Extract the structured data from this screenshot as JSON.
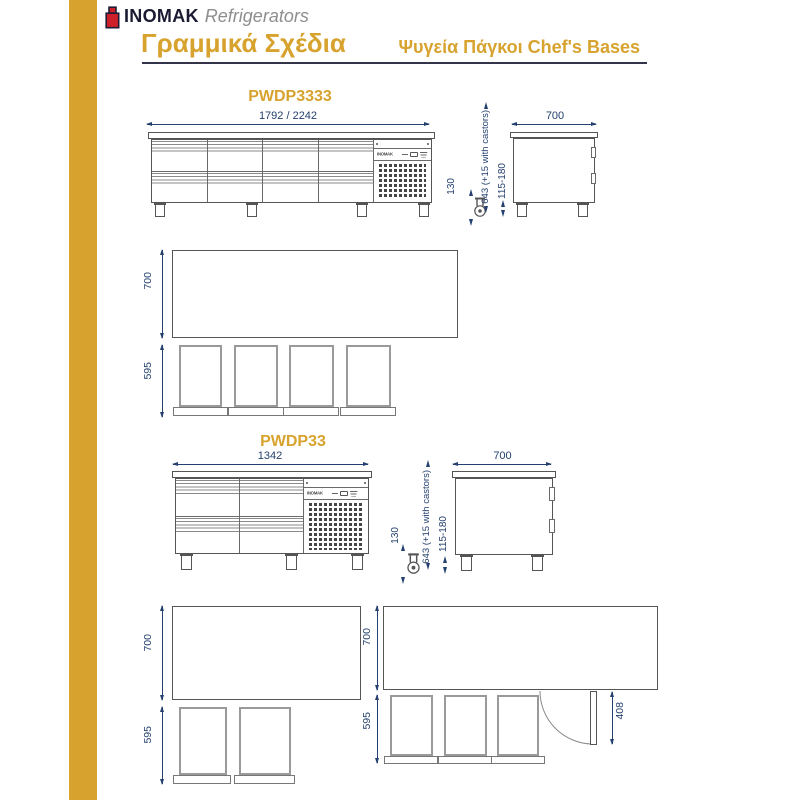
{
  "header": {
    "brand": "INOMAK",
    "brand_suffix": "Refrigerators",
    "section_title": "Γραμμικά Σχέδια",
    "category_title": "Ψυγεία Πάγκοι Chef's Bases"
  },
  "drawing": {
    "compressor_brand": "INOMAK"
  },
  "models": [
    {
      "name": "PWDP3333",
      "front": {
        "width": "1792 / 2242"
      },
      "side": {
        "depth": "700",
        "castor_height": "130",
        "overall_height": "643 (+15 with castors)",
        "leg_height": "115-180"
      },
      "plan": {
        "depth": "700",
        "drawer_depth": "595"
      }
    },
    {
      "name": "PWDP33",
      "front": {
        "width": "1342"
      },
      "side": {
        "depth": "700",
        "castor_height": "130",
        "overall_height": "643 (+15 with castors)",
        "leg_height": "115-180"
      },
      "plan_left": {
        "depth": "700",
        "drawer_depth": "595"
      },
      "plan_right": {
        "depth": "700",
        "drawer_depth": "595",
        "door_swing": "408"
      }
    }
  ],
  "colors": {
    "gold": "#D7A32E",
    "dimension_blue": "#24406E",
    "logo_red": "#CE2029",
    "line_gray": "#555555"
  }
}
